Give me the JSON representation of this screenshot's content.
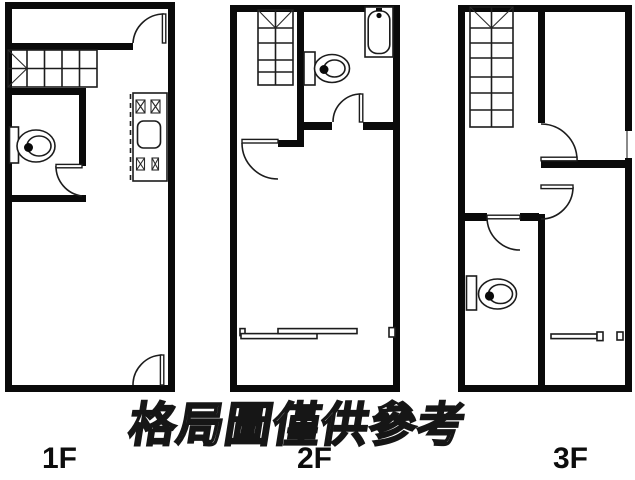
{
  "watermark": "格局圖僅供參考",
  "floors": [
    {
      "id": "1F",
      "label": "1F"
    },
    {
      "id": "2F",
      "label": "2F"
    },
    {
      "id": "3F",
      "label": "3F"
    }
  ],
  "colors": {
    "wall": "#0a0a0a",
    "line": "#1c1c1c",
    "background": "#ffffff",
    "watermark_fill": "#ffffff",
    "watermark_outline": "#161616"
  }
}
